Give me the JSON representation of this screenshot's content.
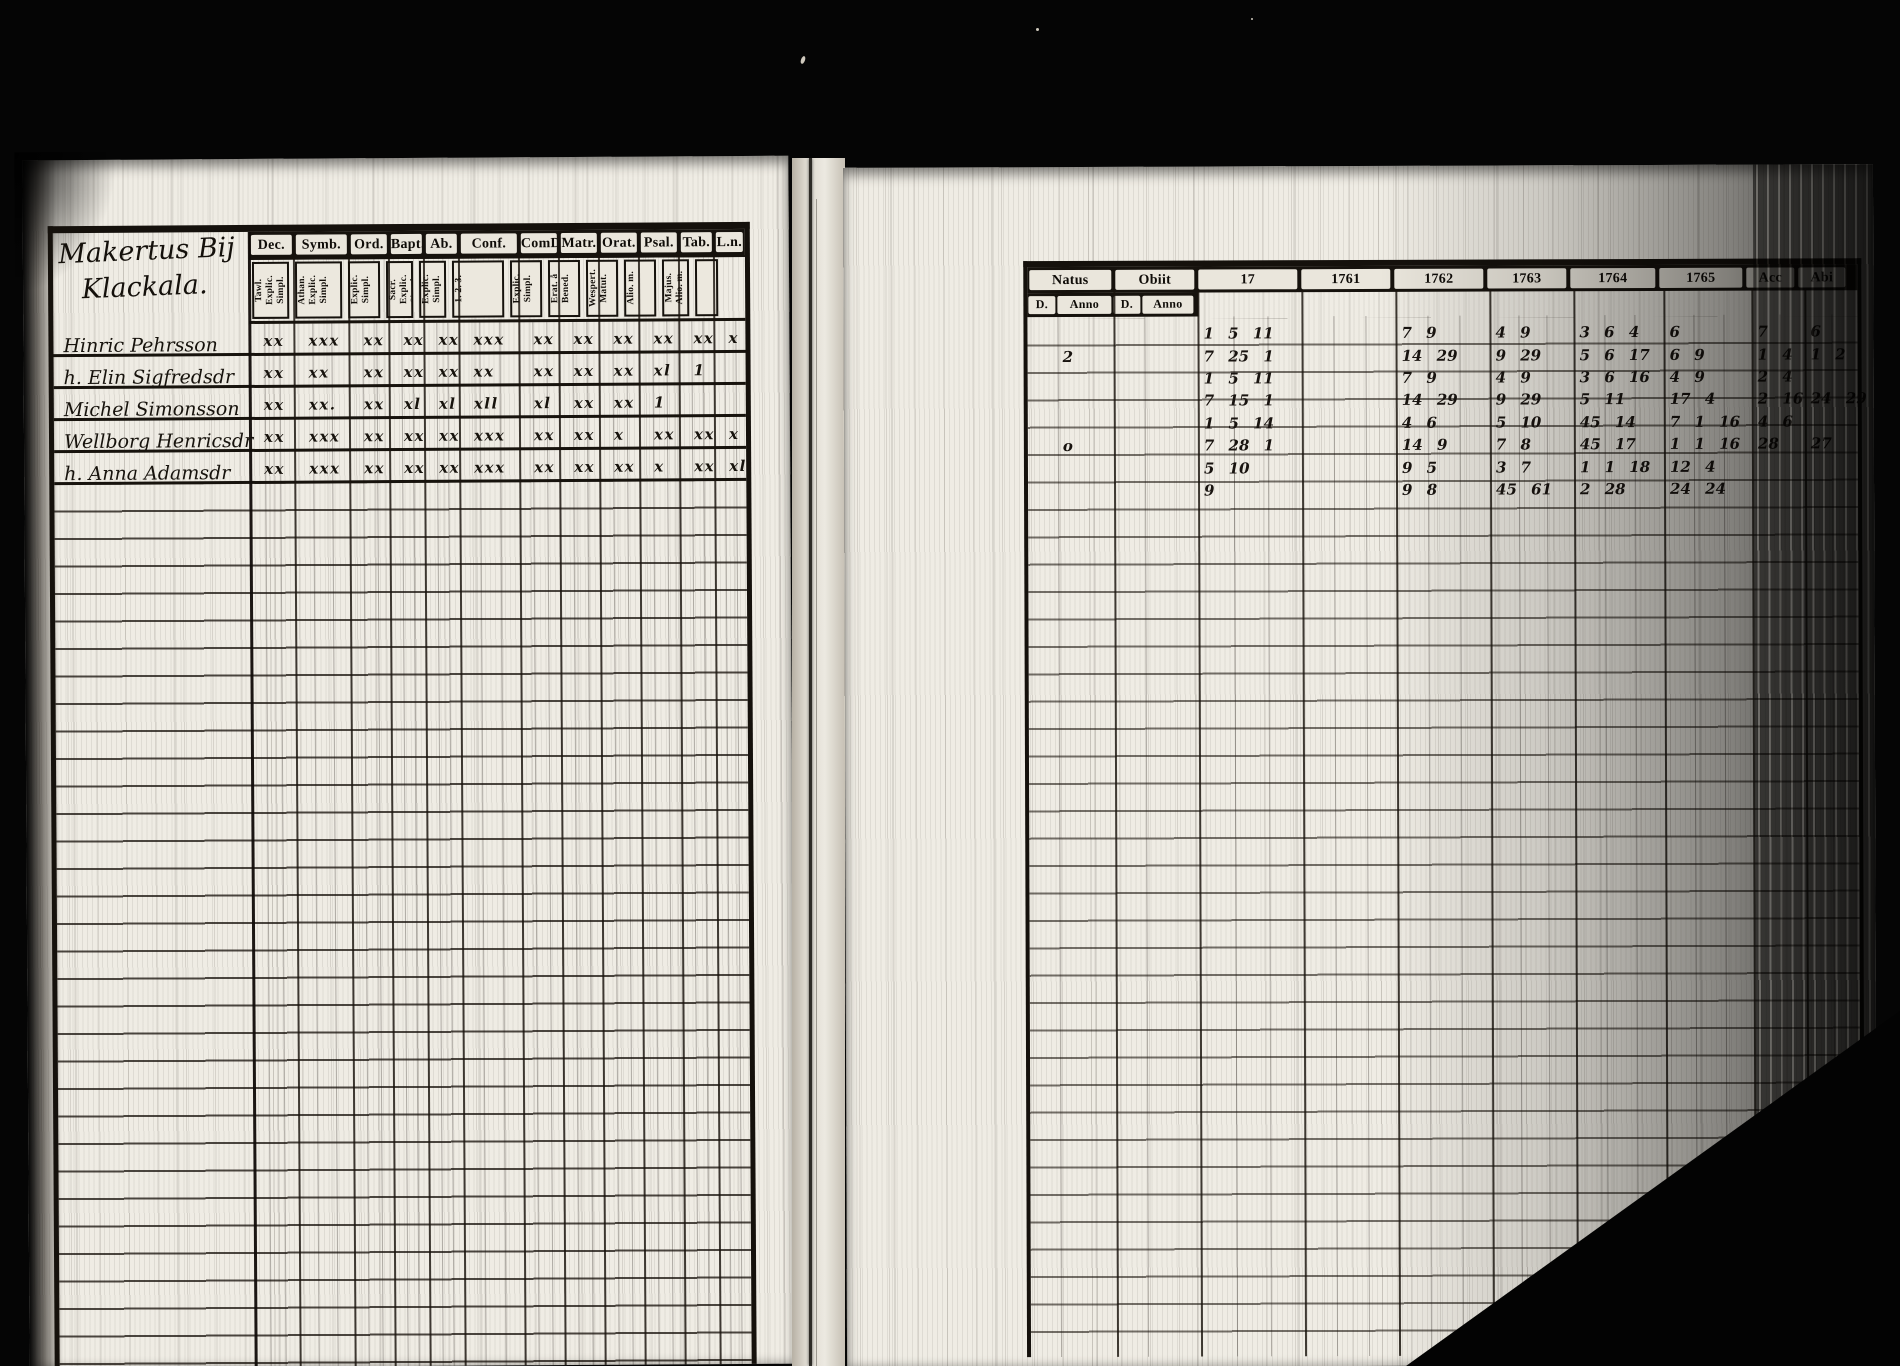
{
  "scan": {
    "left_page": {
      "heading": [
        "Makertus Bij",
        "Klackala."
      ],
      "columns": [
        {
          "label": "Dec.",
          "sub": "Tawl. Explic. Simpl."
        },
        {
          "label": "Symb.",
          "sub": "Athan. Explic. Simpl."
        },
        {
          "label": "Ord.",
          "sub": "Explic. Simpl."
        },
        {
          "label": "Bapt.",
          "sub": "Sacr. Explic. Simpl."
        },
        {
          "label": "Ab.",
          "sub": "Explic. Simpl."
        },
        {
          "label": "Conf.",
          "sub": "1. 2. 3."
        },
        {
          "label": "ComD",
          "sub": "Explic. Simpl."
        },
        {
          "label": "Matr.",
          "sub": "Erat. å Bened."
        },
        {
          "label": "Orat.",
          "sub": "Wespert. Matut."
        },
        {
          "label": "Psal.",
          "sub": "Alio. m."
        },
        {
          "label": "Tab.",
          "sub": "Majus. Alio. m."
        },
        {
          "label": "L.n.",
          "sub": ""
        }
      ],
      "rows": [
        {
          "name": "Hinric Pehrsson",
          "marks": [
            "xx",
            "xxx",
            "xx",
            "xx",
            "xx",
            "xxx",
            "xx",
            "xx",
            "xx",
            "xx",
            "xx",
            "x"
          ]
        },
        {
          "name": "h. Elin Sigfredsdr",
          "marks": [
            "xx",
            "xx",
            "xx",
            "xx",
            "xx",
            "xx",
            "xx",
            "xx",
            "xx",
            "xl",
            "1",
            ""
          ]
        },
        {
          "name": "Michel Simonsson",
          "marks": [
            "xx",
            "xx.",
            "xx",
            "xl",
            "xl",
            "xll",
            "xl",
            "xx",
            "xx",
            "1",
            "",
            ""
          ]
        },
        {
          "name": "Wellborg Henricsdr",
          "marks": [
            "xx",
            "xxx",
            "xx",
            "xx",
            "xx",
            "xxx",
            "xx",
            "xx",
            "x",
            "xx",
            "xx",
            "x"
          ]
        },
        {
          "name": "h. Anna Adamsdr",
          "marks": [
            "xx",
            "xxx",
            "xx",
            "xx",
            "xx",
            "xxx",
            "xx",
            "xx",
            "xx",
            "x",
            "xx",
            "xl"
          ]
        }
      ]
    },
    "right_page": {
      "headers": [
        "Natus",
        "Obiit",
        "17",
        "1761",
        "1762",
        "1763",
        "1764",
        "1765",
        "Acc",
        "Abi"
      ],
      "subheaders": [
        "D.",
        "Anno",
        "D.",
        "Anno"
      ],
      "entries": [
        [
          "",
          "",
          "",
          "",
          "1 5 11",
          "",
          "7 9",
          "4 9",
          "3 6 4",
          "6",
          "7",
          "6"
        ],
        [
          "",
          "2",
          "",
          "",
          "7 25 1",
          "",
          "14 29",
          "9 29",
          "5 6 17",
          "6 9",
          "1 4",
          "1 2"
        ],
        [
          "",
          "",
          "",
          "",
          "1 5 11",
          "",
          "7 9",
          "4 9",
          "3 6 16",
          "4 9",
          "2 4",
          ""
        ],
        [
          "",
          "",
          "",
          "",
          "7 15 1",
          "",
          "14 29",
          "9 29",
          "5 11",
          "17 4",
          "2 16",
          "24 29"
        ],
        [
          "",
          "",
          "",
          "",
          "1 5 14",
          "",
          "4 6",
          "5 10",
          "45 14",
          "7 1 16",
          "4 6",
          ""
        ],
        [
          "",
          "o",
          "",
          "",
          "7 28 1",
          "",
          "14 9",
          "7 8",
          "45 17",
          "1 1 16",
          "28",
          "27"
        ],
        [
          "",
          "",
          "",
          "",
          "5 10",
          "",
          "9 5",
          "3 7",
          "1 1 18",
          "12 4",
          "",
          ""
        ],
        [
          "",
          "",
          "",
          "",
          "9",
          "",
          "9 8",
          "45 61",
          "2 28",
          "24 24",
          "",
          ""
        ]
      ]
    }
  }
}
